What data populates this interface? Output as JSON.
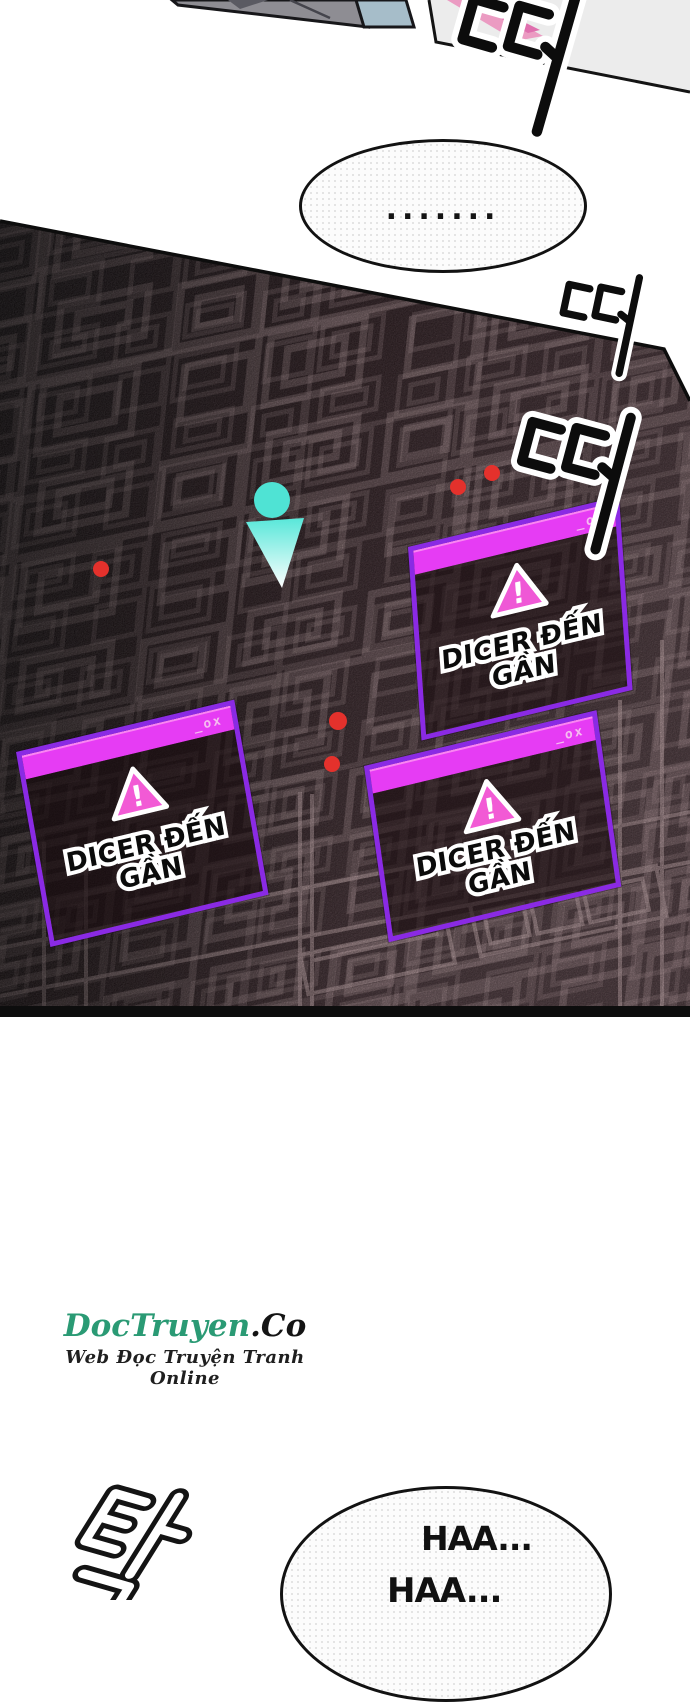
{
  "page": {
    "background": "#ffffff",
    "kind": "webtoon panel page"
  },
  "speech_bubbles": {
    "ellipsis_bubble": {
      "text": "......."
    },
    "breathing_bubble": {
      "line1": "HAA...",
      "line2": "HAA..."
    }
  },
  "alerts": {
    "count": 3,
    "title_controls": "_ox",
    "warning_glyph": "!",
    "message": "DICER ĐẾN GẦN",
    "colors": {
      "titlebar": "#e63cf4",
      "border": "#8a2ae4",
      "triangle": "#f25ad5",
      "body_tint": "#1a0c10"
    }
  },
  "minimap": {
    "enemy_dot_count": 5,
    "enemy_dot_color": "#e4312c",
    "player_marker_color": "#4fe3d4",
    "wireframe_color": "#cfb0b3"
  },
  "sfx": [
    {
      "name": "beep-top",
      "text": "띠",
      "meaning": "beep"
    },
    {
      "name": "beep-upper-right",
      "text": "띠",
      "meaning": "beep"
    },
    {
      "name": "beep-lower-right",
      "text": "띠",
      "meaning": "beep"
    },
    {
      "name": "thud-bottom-left",
      "text": "탁",
      "meaning": "thud"
    }
  ],
  "watermark": {
    "site_name": "DocTruyen",
    "site_tld": ".Co",
    "site_color": "#2a9a74",
    "tagline": "Web Đọc Truyện Tranh Online"
  }
}
